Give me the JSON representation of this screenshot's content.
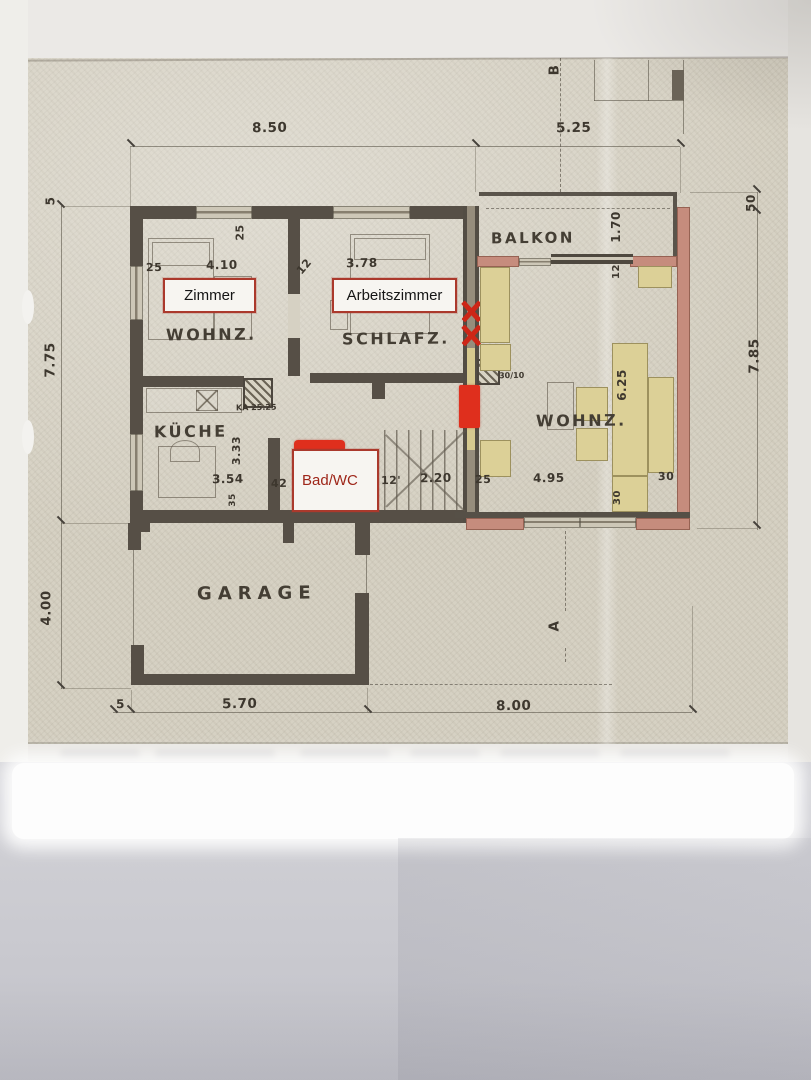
{
  "plan": {
    "rooms": {
      "wohnz_left": "WOHNZ.",
      "schlafz": "SCHLAFZ.",
      "kueche": "KÜCHE",
      "garage": "GARAGE",
      "balkon": "BALKON",
      "wohnz_right": "WOHNZ."
    },
    "overlays": {
      "zimmer": "Zimmer",
      "arbeitszimmer": "Arbeitszimmer",
      "bad_wc": "Bad/WC"
    },
    "sections": {
      "a": "A",
      "b": "B"
    },
    "dims": {
      "top_span": "8.50",
      "top_span_right": "5.25",
      "left_offset": "5",
      "left_height": "7.75",
      "left_garage": "4.00",
      "right_offset": "50",
      "right_height": "7.85",
      "bottom_offset": "5",
      "bottom_garage": "5.70",
      "bottom_span": "8.00",
      "wall25_top": "25",
      "zimmer_w": "4.10",
      "wall12": "12",
      "arbeits_w": "3.78",
      "wall25_v": "25",
      "balkon_d": "1.70",
      "balkon_wall": "12",
      "kueche_h": "3.33",
      "kueche_w": "3.54",
      "wall35": "35",
      "flur42": "42",
      "flur12": "12'",
      "stairs220": "2.20",
      "wall25_m": "25",
      "wohnz_w": "4.95",
      "wall30": "30",
      "sofa625": "6.25",
      "bench30": "30",
      "kamin_kitchen": "KA 25.25",
      "kamin_living": "KA 30/10"
    },
    "colors": {
      "annotation_red": "#df2f1d",
      "wall_pink": "#c68c7d",
      "furniture_yellow": "#dcd097",
      "paper": "#d6d1c3",
      "label_border": "#ab392c"
    }
  }
}
